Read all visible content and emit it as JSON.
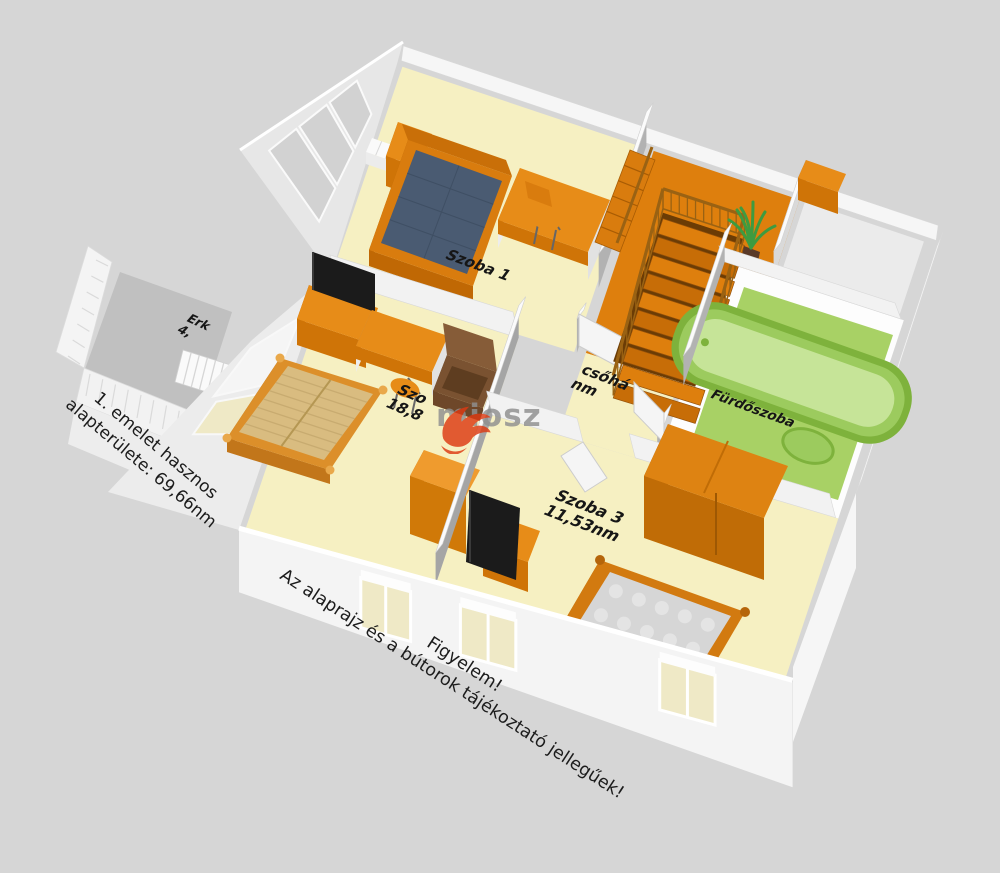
{
  "rooms": {
    "szoba1": {
      "name": "Szoba 1"
    },
    "szoba2": {
      "name": "Szo",
      "area": "18,8"
    },
    "szoba3": {
      "name": "Szoba 3",
      "area": "11,53nm"
    },
    "stairhall": {
      "name": "csőhá",
      "area": "nm"
    },
    "bathroom": {
      "name": "Fürdőszoba"
    },
    "balcony": {
      "name": "Erk",
      "area": "4,"
    }
  },
  "notes": {
    "area_line1": "1. emelet hasznos",
    "area_line2": "alapterülete: 69,66nm",
    "warn_line1": "Figyelem!",
    "warn_line2": "Az alaprajz és a bútorok tájékoztató jellegűek!"
  },
  "watermark": {
    "text": "miosz"
  },
  "colors": {
    "bg": "#d6d6d6",
    "wall_white": "#f6f6f6",
    "wall_top": "#fbfbfb",
    "wall_shade_west": "#b2b2b2",
    "wall_shade_light": "#d9d9d9",
    "wall_face_east": "#e9e9e9",
    "floor_cream": "#f6f0c2",
    "floor_orange": "#de7f0d",
    "step_dark": "#c76d07",
    "stairwell": "#6b3c05",
    "rail_brown": "#9a6213",
    "furn_top": "#e78c18",
    "furn_front": "#cf7407",
    "furn_side": "#b26104",
    "mattress_blue": "#4a5b72",
    "mattress_gray": "#d6d6d6",
    "quilt_dot": "#e4e4e4",
    "mattress_tan": "#d9bc80",
    "slat_line": "#c8ab70",
    "tv_black": "#1b1b1b",
    "tub_rim": "#7eb23c",
    "tub_mid": "#9ccb5e",
    "tub_inner": "#c6e498",
    "mat_green": "#a8d165",
    "balcony_gray": "#c0c0c0",
    "ne_floor": "#ebebeb",
    "glass_cream": "#efe9c6",
    "window_pane": "#d2d2d2",
    "armchair": "#7a5231",
    "armchair_dark": "#5e3d20",
    "armchair_light": "#865c38",
    "plant_green": "#3e9b40",
    "plant_pot": "#5a3a28",
    "wm_red": "#dd3a12",
    "wm_gray": "#8f8f8f"
  }
}
